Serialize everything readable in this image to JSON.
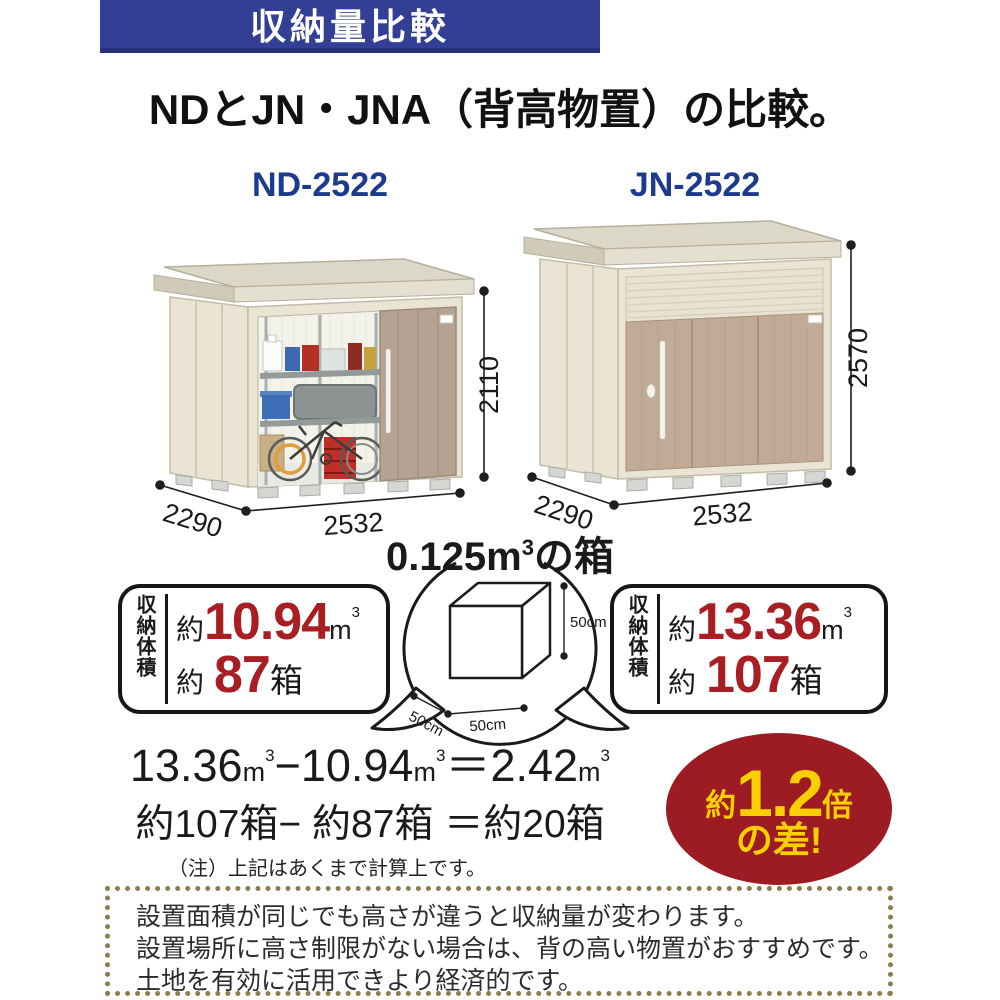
{
  "banner": {
    "title": "収納量比較"
  },
  "heading": {
    "title": "NDとJN・JNA（背高物置）の比較。"
  },
  "sheds": {
    "left": {
      "model": "ND-2522",
      "width": "2532",
      "depth": "2290",
      "height": "2110"
    },
    "right": {
      "model": "JN-2522",
      "width": "2532",
      "depth": "2290",
      "height": "2570"
    }
  },
  "box_reference": {
    "title_pre": "0.125m",
    "title_sup": "3",
    "title_post": "の箱",
    "dim_height": "50cm",
    "dim_width": "50cm",
    "dim_depth": "50cm"
  },
  "capacity": {
    "left": {
      "label": "収納体積",
      "row1_prefix": "約",
      "row1_value": "10.94",
      "row1_unit": "m",
      "row1_sup": "3",
      "row2_prefix": "約",
      "row2_value": "87",
      "row2_unit": "箱"
    },
    "right": {
      "label": "収納体積",
      "row1_prefix": "約",
      "row1_value": "13.36",
      "row1_unit": "m",
      "row1_sup": "3",
      "row2_prefix": "約",
      "row2_value": "107",
      "row2_unit": "箱"
    }
  },
  "calculation": {
    "line1": {
      "a": "13.36",
      "a_unit": "m",
      "a_sup": "3",
      "minus": "−",
      "b": "10.94",
      "b_unit": "m",
      "b_sup": "3",
      "equals": "＝",
      "c": "2.42",
      "c_unit": "m",
      "c_sup": "3"
    },
    "line2": "約107箱− 約87箱 ＝約20箱",
    "note": "（注）上記はあくまで計算上です。"
  },
  "badge": {
    "prefix": "約",
    "value": "1.2",
    "suffix": "倍",
    "line2": "の差!"
  },
  "notice": {
    "lines": [
      "設置面積が同じでも高さが違うと収納量が変わります。",
      "設置場所に高さ制限がない場合は、背の高い物置がおすすめです。",
      "土地を有効に活用できより経済的です。"
    ]
  },
  "colors": {
    "banner_blue": "#333e95",
    "model_navy": "#1c3a8e",
    "accent_red": "#a81e23",
    "badge_red": "#9d1b22",
    "badge_yellow": "#f8cf00",
    "dotted_border": "#8b7d4d",
    "wall_cream": "#e9e4d3",
    "door_taupe": "#b5a292"
  }
}
